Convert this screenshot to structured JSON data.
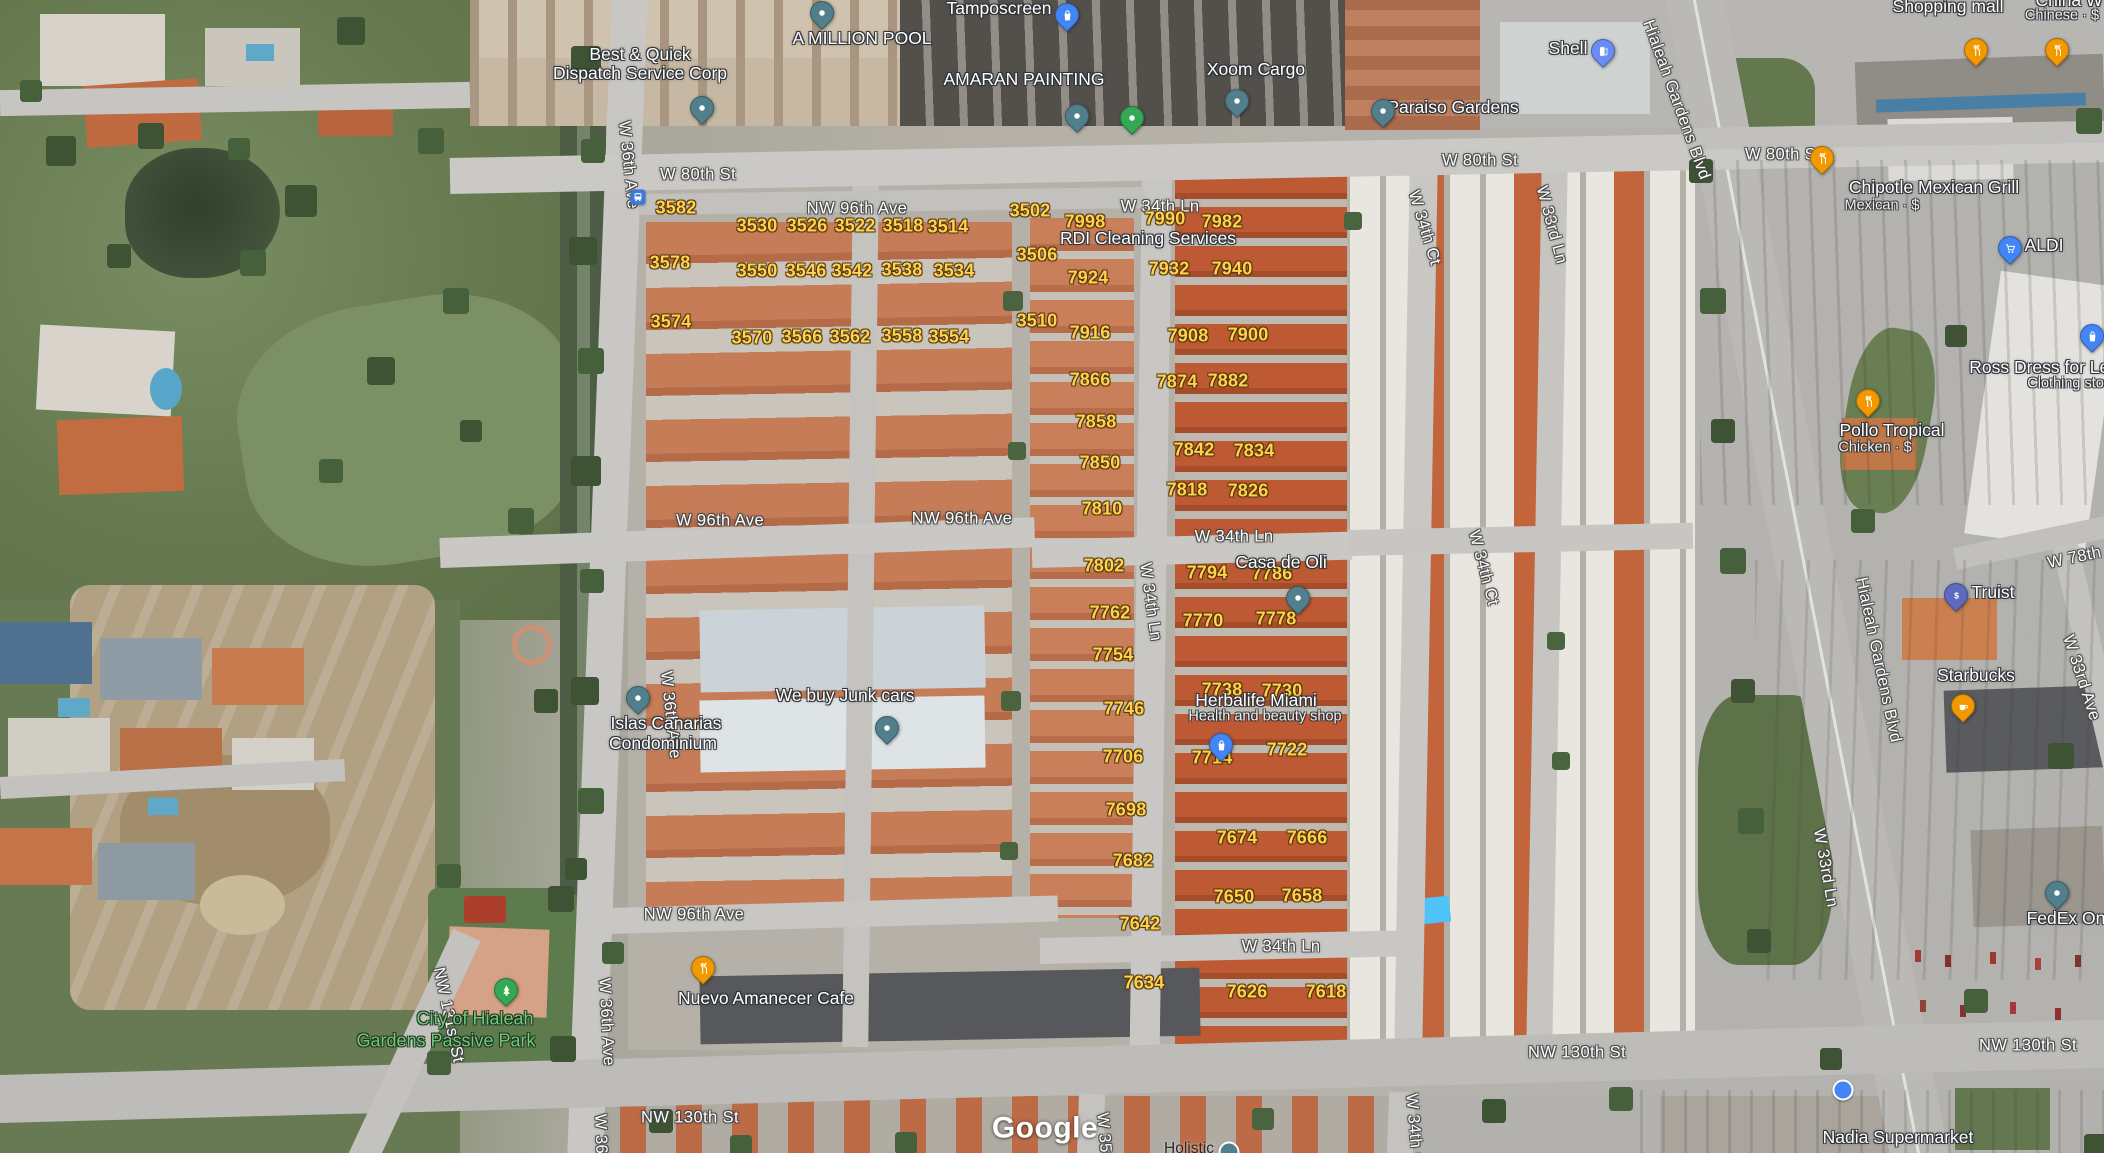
{
  "map": {
    "attribution": "Google",
    "texts": [
      {
        "t": "W 80th St",
        "x": 698,
        "y": 175,
        "c": "street"
      },
      {
        "t": "W 80th St",
        "x": 1480,
        "y": 161,
        "c": "street"
      },
      {
        "t": "W 80th St",
        "x": 1783,
        "y": 155,
        "c": "street"
      },
      {
        "t": "NW 96th Ave",
        "x": 857,
        "y": 209,
        "c": "street"
      },
      {
        "t": "W 34th Ln",
        "x": 1160,
        "y": 207,
        "c": "street"
      },
      {
        "t": "W 96th Ave",
        "x": 720,
        "y": 521,
        "c": "street"
      },
      {
        "t": "NW 96th Ave",
        "x": 962,
        "y": 519,
        "c": "street"
      },
      {
        "t": "W 34th Ln",
        "x": 1234,
        "y": 537,
        "c": "street"
      },
      {
        "t": "W 34th Ln",
        "x": 1150,
        "y": 602,
        "c": "street",
        "r": 82
      },
      {
        "t": "W 34th Ln",
        "x": 1281,
        "y": 947,
        "c": "street"
      },
      {
        "t": "NW 96th Ave",
        "x": 694,
        "y": 915,
        "c": "street"
      },
      {
        "t": "NW 130th St",
        "x": 690,
        "y": 1118,
        "c": "street"
      },
      {
        "t": "NW 130th St",
        "x": 1577,
        "y": 1053,
        "c": "street"
      },
      {
        "t": "NW 130th St",
        "x": 2028,
        "y": 1046,
        "c": "street"
      },
      {
        "t": "NW 131st St",
        "x": 448,
        "y": 1015,
        "c": "street",
        "r": 78
      },
      {
        "t": "W 36th Ave",
        "x": 628,
        "y": 165,
        "c": "street",
        "r": 84
      },
      {
        "t": "W 36th Ave",
        "x": 670,
        "y": 715,
        "c": "street",
        "r": 84
      },
      {
        "t": "W 36th Ave",
        "x": 606,
        "y": 1022,
        "c": "street",
        "r": 87
      },
      {
        "t": "W 36th Ave",
        "x": 601,
        "y": 1158,
        "c": "street",
        "r": 88
      },
      {
        "t": "W 34th Ct",
        "x": 1424,
        "y": 228,
        "c": "street",
        "r": 73
      },
      {
        "t": "W 33rd Ln",
        "x": 1551,
        "y": 225,
        "c": "street",
        "r": 75
      },
      {
        "t": "W 34th Ct",
        "x": 1483,
        "y": 568,
        "c": "street",
        "r": 75
      },
      {
        "t": "W 33rd Ln",
        "x": 1825,
        "y": 868,
        "c": "street",
        "r": 80
      },
      {
        "t": "Hialeah Gardens Blvd",
        "x": 1676,
        "y": 100,
        "c": "street",
        "r": 70
      },
      {
        "t": "Hialeah Gardens Blvd",
        "x": 1878,
        "y": 660,
        "c": "street",
        "r": 78
      },
      {
        "t": "W 33rd Ave",
        "x": 2081,
        "y": 678,
        "c": "street",
        "r": 72
      },
      {
        "t": "W 78th St",
        "x": 2085,
        "y": 556,
        "c": "street",
        "r": -12
      },
      {
        "t": "W 35th",
        "x": 1104,
        "y": 1140,
        "c": "street",
        "r": 85
      },
      {
        "t": "W 34th Ct",
        "x": 1414,
        "y": 1132,
        "c": "street",
        "r": 85
      },
      {
        "t": "3582",
        "x": 676,
        "y": 208,
        "c": "num"
      },
      {
        "t": "3578",
        "x": 670,
        "y": 263,
        "c": "num"
      },
      {
        "t": "3574",
        "x": 671,
        "y": 322,
        "c": "num"
      },
      {
        "t": "3530",
        "x": 757,
        "y": 226,
        "c": "num"
      },
      {
        "t": "3526",
        "x": 807,
        "y": 226,
        "c": "num"
      },
      {
        "t": "3522",
        "x": 855,
        "y": 226,
        "c": "num"
      },
      {
        "t": "3518",
        "x": 903,
        "y": 226,
        "c": "num"
      },
      {
        "t": "3514",
        "x": 948,
        "y": 227,
        "c": "num"
      },
      {
        "t": "3550",
        "x": 757,
        "y": 271,
        "c": "num"
      },
      {
        "t": "3546",
        "x": 806,
        "y": 271,
        "c": "num"
      },
      {
        "t": "3542",
        "x": 852,
        "y": 271,
        "c": "num"
      },
      {
        "t": "3538",
        "x": 902,
        "y": 270,
        "c": "num"
      },
      {
        "t": "3534",
        "x": 954,
        "y": 271,
        "c": "num"
      },
      {
        "t": "3570",
        "x": 752,
        "y": 338,
        "c": "num"
      },
      {
        "t": "3566",
        "x": 802,
        "y": 337,
        "c": "num"
      },
      {
        "t": "3562",
        "x": 850,
        "y": 337,
        "c": "num"
      },
      {
        "t": "3558",
        "x": 902,
        "y": 336,
        "c": "num"
      },
      {
        "t": "3554",
        "x": 949,
        "y": 337,
        "c": "num"
      },
      {
        "t": "3502",
        "x": 1030,
        "y": 211,
        "c": "num"
      },
      {
        "t": "3506",
        "x": 1037,
        "y": 255,
        "c": "num"
      },
      {
        "t": "3510",
        "x": 1037,
        "y": 321,
        "c": "num"
      },
      {
        "t": "7998",
        "x": 1085,
        "y": 222,
        "c": "num"
      },
      {
        "t": "7990",
        "x": 1165,
        "y": 219,
        "c": "num"
      },
      {
        "t": "7982",
        "x": 1222,
        "y": 222,
        "c": "num"
      },
      {
        "t": "7932",
        "x": 1169,
        "y": 269,
        "c": "num"
      },
      {
        "t": "7940",
        "x": 1232,
        "y": 269,
        "c": "num"
      },
      {
        "t": "7924",
        "x": 1088,
        "y": 278,
        "c": "num"
      },
      {
        "t": "7916",
        "x": 1090,
        "y": 333,
        "c": "num"
      },
      {
        "t": "7908",
        "x": 1188,
        "y": 336,
        "c": "num"
      },
      {
        "t": "7900",
        "x": 1248,
        "y": 335,
        "c": "num"
      },
      {
        "t": "7866",
        "x": 1090,
        "y": 380,
        "c": "num"
      },
      {
        "t": "7874",
        "x": 1177,
        "y": 382,
        "c": "num"
      },
      {
        "t": "7882",
        "x": 1228,
        "y": 381,
        "c": "num"
      },
      {
        "t": "7858",
        "x": 1096,
        "y": 422,
        "c": "num"
      },
      {
        "t": "7850",
        "x": 1100,
        "y": 463,
        "c": "num"
      },
      {
        "t": "7842",
        "x": 1194,
        "y": 450,
        "c": "num"
      },
      {
        "t": "7834",
        "x": 1254,
        "y": 451,
        "c": "num"
      },
      {
        "t": "7818",
        "x": 1187,
        "y": 490,
        "c": "num"
      },
      {
        "t": "7826",
        "x": 1248,
        "y": 491,
        "c": "num"
      },
      {
        "t": "7810",
        "x": 1102,
        "y": 509,
        "c": "num"
      },
      {
        "t": "7802",
        "x": 1104,
        "y": 566,
        "c": "num"
      },
      {
        "t": "7794",
        "x": 1207,
        "y": 573,
        "c": "num"
      },
      {
        "t": "7786",
        "x": 1272,
        "y": 574,
        "c": "num"
      },
      {
        "t": "7762",
        "x": 1110,
        "y": 613,
        "c": "num"
      },
      {
        "t": "7770",
        "x": 1203,
        "y": 621,
        "c": "num"
      },
      {
        "t": "7778",
        "x": 1276,
        "y": 619,
        "c": "num"
      },
      {
        "t": "7754",
        "x": 1113,
        "y": 655,
        "c": "num"
      },
      {
        "t": "7746",
        "x": 1124,
        "y": 709,
        "c": "num"
      },
      {
        "t": "7738",
        "x": 1222,
        "y": 690,
        "c": "num"
      },
      {
        "t": "7730",
        "x": 1282,
        "y": 691,
        "c": "num"
      },
      {
        "t": "7714",
        "x": 1212,
        "y": 758,
        "c": "num"
      },
      {
        "t": "7722",
        "x": 1287,
        "y": 750,
        "c": "num"
      },
      {
        "t": "7706",
        "x": 1123,
        "y": 757,
        "c": "num"
      },
      {
        "t": "7698",
        "x": 1126,
        "y": 810,
        "c": "num"
      },
      {
        "t": "7682",
        "x": 1133,
        "y": 861,
        "c": "num"
      },
      {
        "t": "7674",
        "x": 1237,
        "y": 838,
        "c": "num"
      },
      {
        "t": "7666",
        "x": 1307,
        "y": 838,
        "c": "num"
      },
      {
        "t": "7650",
        "x": 1234,
        "y": 897,
        "c": "num"
      },
      {
        "t": "7658",
        "x": 1302,
        "y": 896,
        "c": "num"
      },
      {
        "t": "7642",
        "x": 1140,
        "y": 924,
        "c": "num"
      },
      {
        "t": "7634",
        "x": 1144,
        "y": 983,
        "c": "num"
      },
      {
        "t": "7626",
        "x": 1247,
        "y": 992,
        "c": "num"
      },
      {
        "t": "7618",
        "x": 1326,
        "y": 992,
        "c": "num"
      },
      {
        "t": "Best & Quick",
        "x": 640,
        "y": 54,
        "c": "poi"
      },
      {
        "t": "Dispatch Service Corp",
        "x": 640,
        "y": 73,
        "c": "poi"
      },
      {
        "t": "A MILLION POOL",
        "x": 862,
        "y": 38,
        "c": "poi"
      },
      {
        "t": "Tamposcreen",
        "x": 999,
        "y": 8,
        "c": "poi"
      },
      {
        "t": "AMARAN PAINTING",
        "x": 1024,
        "y": 79,
        "c": "poi"
      },
      {
        "t": "Xoom Cargo",
        "x": 1256,
        "y": 69,
        "c": "poi"
      },
      {
        "t": "Paraiso Gardens",
        "x": 1453,
        "y": 107,
        "c": "poi"
      },
      {
        "t": "Shell",
        "x": 1568,
        "y": 48,
        "c": "poi"
      },
      {
        "t": "Shopping mall",
        "x": 1948,
        "y": 6,
        "c": "poi"
      },
      {
        "t": "China W",
        "x": 2069,
        "y": 0,
        "c": "poi"
      },
      {
        "t": "Chinese · $",
        "x": 2062,
        "y": 16,
        "c": "sub"
      },
      {
        "t": "RDI Cleaning Services",
        "x": 1148,
        "y": 238,
        "c": "poi"
      },
      {
        "t": "Chipotle Mexican Grill",
        "x": 1934,
        "y": 187,
        "c": "poi"
      },
      {
        "t": "Mexican · $",
        "x": 1882,
        "y": 206,
        "c": "sub"
      },
      {
        "t": "ALDI",
        "x": 2044,
        "y": 245,
        "c": "poi"
      },
      {
        "t": "Ross Dress for Less",
        "x": 2048,
        "y": 367,
        "c": "poi"
      },
      {
        "t": "Clothing store",
        "x": 2072,
        "y": 384,
        "c": "sub"
      },
      {
        "t": "Pollo Tropical",
        "x": 1892,
        "y": 430,
        "c": "poi"
      },
      {
        "t": "Chicken · $",
        "x": 1875,
        "y": 448,
        "c": "sub"
      },
      {
        "t": "Truist",
        "x": 1993,
        "y": 592,
        "c": "poi"
      },
      {
        "t": "Starbucks",
        "x": 1976,
        "y": 675,
        "c": "poi"
      },
      {
        "t": "FedEx On",
        "x": 2066,
        "y": 918,
        "c": "poi"
      },
      {
        "t": "Nadia Supermarket",
        "x": 1898,
        "y": 1137,
        "c": "poi"
      },
      {
        "t": "Casa de Oli",
        "x": 1281,
        "y": 562,
        "c": "poi"
      },
      {
        "t": "Herbalife Miami",
        "x": 1256,
        "y": 700,
        "c": "poi"
      },
      {
        "t": "Health and beauty shop",
        "x": 1265,
        "y": 717,
        "c": "sub"
      },
      {
        "t": "We buy Junk cars",
        "x": 845,
        "y": 695,
        "c": "poi"
      },
      {
        "t": "Islas Canarias",
        "x": 666,
        "y": 723,
        "c": "poi"
      },
      {
        "t": "Condominium",
        "x": 663,
        "y": 743,
        "c": "poi"
      },
      {
        "t": "Nuevo Amanecer Cafe",
        "x": 766,
        "y": 998,
        "c": "poi"
      },
      {
        "t": "City of Hialeah",
        "x": 475,
        "y": 1019,
        "c": "green"
      },
      {
        "t": "Gardens Passive Park",
        "x": 446,
        "y": 1041,
        "c": "green"
      },
      {
        "t": "Holistic",
        "x": 1189,
        "y": 1149,
        "c": "dark"
      },
      {
        "t": "Google",
        "x": 1045,
        "y": 1128,
        "c": "brand"
      }
    ],
    "pins": [
      {
        "icon": "dot",
        "color": "pin_teal",
        "x": 702,
        "y": 120
      },
      {
        "icon": "dot",
        "color": "pin_teal",
        "x": 822,
        "y": 25
      },
      {
        "icon": "bag",
        "color": "pin_blue",
        "x": 1067,
        "y": 27
      },
      {
        "icon": "dot",
        "color": "pin_teal",
        "x": 1077,
        "y": 128
      },
      {
        "icon": "dot",
        "color": "pin_green",
        "x": 1132,
        "y": 130
      },
      {
        "icon": "dot",
        "color": "pin_teal",
        "x": 1237,
        "y": 113
      },
      {
        "icon": "dot",
        "color": "pin_teal",
        "x": 1383,
        "y": 123
      },
      {
        "icon": "gas",
        "color": "pin_gas_blue",
        "x": 1603,
        "y": 63
      },
      {
        "icon": "restaurant",
        "color": "pin_orange",
        "x": 1976,
        "y": 62
      },
      {
        "icon": "restaurant",
        "color": "pin_orange",
        "x": 2057,
        "y": 62
      },
      {
        "icon": "restaurant",
        "color": "pin_orange",
        "x": 1822,
        "y": 170
      },
      {
        "icon": "cart",
        "color": "pin_blue",
        "x": 2010,
        "y": 260
      },
      {
        "icon": "bag",
        "color": "pin_blue",
        "x": 2092,
        "y": 348
      },
      {
        "icon": "restaurant",
        "color": "pin_orange",
        "x": 1868,
        "y": 413
      },
      {
        "icon": "dollar",
        "color": "pin_indigo",
        "x": 1956,
        "y": 607
      },
      {
        "icon": "coffee",
        "color": "pin_orange",
        "x": 1963,
        "y": 718
      },
      {
        "icon": "dot",
        "color": "pin_teal",
        "x": 2057,
        "y": 905
      },
      {
        "icon": "circle",
        "color": "pin_blue",
        "x": 1843,
        "y": 1090
      },
      {
        "icon": "dot",
        "color": "pin_teal",
        "x": 1298,
        "y": 610
      },
      {
        "icon": "bag",
        "color": "pin_blue",
        "x": 1221,
        "y": 757
      },
      {
        "icon": "dot",
        "color": "pin_teal",
        "x": 887,
        "y": 740
      },
      {
        "icon": "dot",
        "color": "pin_teal",
        "x": 638,
        "y": 710
      },
      {
        "icon": "restaurant",
        "color": "pin_orange",
        "x": 703,
        "y": 980
      },
      {
        "icon": "tree",
        "color": "pin_green",
        "x": 506,
        "y": 1002
      },
      {
        "icon": "bus",
        "color": "bus_blue",
        "x": 638,
        "y": 197
      },
      {
        "icon": "circle",
        "color": "pin_teal",
        "x": 1229,
        "y": 1152
      }
    ]
  },
  "colors": {
    "house_number": "#ffd24f",
    "street_label": "#ffffff",
    "park_label": "#6ecb7a",
    "pin_teal": "#527f8c",
    "pin_green": "#34a853",
    "pin_blue": "#4285f4",
    "pin_orange": "#f29900",
    "pin_indigo": "#5c6bc0",
    "pin_gas_blue": "#6b8bf5",
    "bus_blue": "#3b78dc"
  }
}
